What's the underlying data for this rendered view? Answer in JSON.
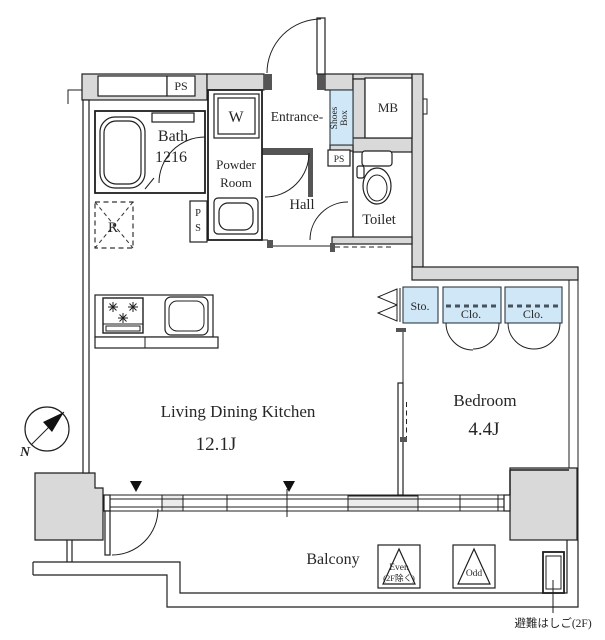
{
  "plan": {
    "title": "apartment-floor-plan",
    "labels": {
      "ps_top": "PS",
      "bath1": "Bath",
      "bath2": "1216",
      "washer": "W",
      "powder1": "Powder",
      "powder2": "Room",
      "ps_v1": "P",
      "ps_v2": "S",
      "entrance": "Entrance-",
      "shoes1": "Shoes",
      "shoes2": "Box",
      "mb": "MB",
      "ps_small": "PS",
      "hall": "Hall",
      "toilet": "Toilet",
      "fridge": "R",
      "sto": "Sto.",
      "clo1": "Clo.",
      "clo2": "Clo.",
      "ldk1": "Living Dining Kitchen",
      "ldk2": "12.1J",
      "bed1": "Bedroom",
      "bed2": "4.4J",
      "balcony": "Balcony",
      "even1": "Even",
      "even2": "(2F除く)",
      "odd": "Odd",
      "ladder_note": "避難はしご(2F)",
      "compass_north": "N"
    },
    "areas": {
      "living_dining_kitchen_jo": "12.1J",
      "bedroom_jo": "4.4J",
      "bath_size": "1216"
    },
    "colors": {
      "wall": "#d9d9d9",
      "closet_fill": "#cfe7f6",
      "line": "#1f1f1f"
    }
  }
}
